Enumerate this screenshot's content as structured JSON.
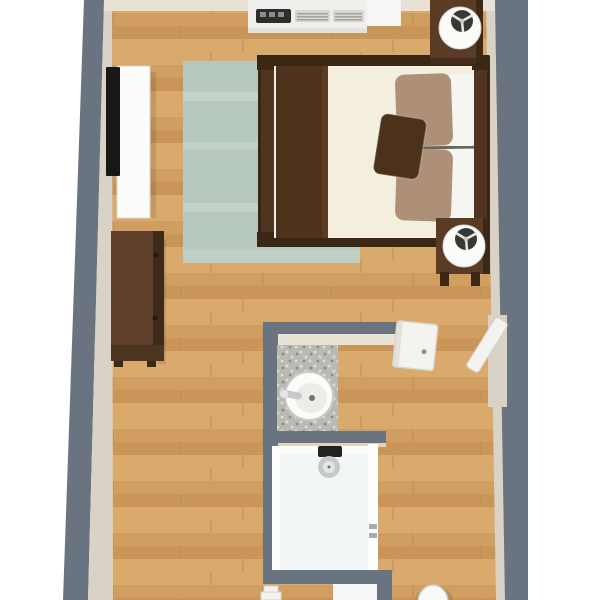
{
  "scene": {
    "objects": [
      "bedroom-floorplan",
      "wood-floor",
      "area-rug",
      "double-bed",
      "brown-blanket",
      "bed-pillows",
      "accent-pillow",
      "headboard",
      "footboard",
      "nightstand-top",
      "nightstand-bottom",
      "table-lamp-top",
      "table-lamp-bottom",
      "wall-tv",
      "tv-console",
      "dresser",
      "ptac-air-conditioner",
      "bathroom",
      "granite-vanity",
      "vessel-sink",
      "faucet",
      "walk-in-shower",
      "shower-head",
      "glass-panel",
      "bathroom-door",
      "entry-door",
      "toilet",
      "gray-walls"
    ]
  },
  "colors": {
    "bg": "#ffffff",
    "wall": "#6a7480",
    "wall_face": "#d9d3c7",
    "wall_face_light": "#e8e2d5",
    "floor_base": "#d6a265",
    "plank_a": "#deb074",
    "plank_b": "#cd9a5d",
    "plank_c": "#c08a50",
    "plank_seam": "#a97b45",
    "rug": "#b7c9bd",
    "rug_streak": "#cedbd0",
    "bed_frame": "#4f351f",
    "bed_frame_dark": "#3a2715",
    "mattress": "#f3eedd",
    "blanket": "#4e321b",
    "blanket_fold": "#5f3e23",
    "pillow_tan": "#ae8f77",
    "pillow_white": "#f5f5f2",
    "pillow_brown": "#4c311b",
    "pillow_highlight": "rgba(255,255,255,0.25)",
    "crease": "#4a463f",
    "nightstand": "#5a3c26",
    "nightstand_dark": "#3b2817",
    "lamp_shade": "#fbfbfa",
    "lamp_inner": "#3a3834",
    "lamp_glint": "#e8e8e6",
    "tv": "#181817",
    "console": "#fcfcfb",
    "console_shadow": "#d9d8d3",
    "ac_body": "#f0efed",
    "ac_cap": "#f7f6f4",
    "ac_panel": "#2e2d2c",
    "ac_button": "#8d8c8a",
    "ac_grille": "#d7d6d3",
    "ac_slat": "#a3a29f",
    "dresser_top": "#5e3f2a",
    "dresser_side": "#3f2a1a",
    "dresser_front": "#4d3421",
    "handle": "#241911",
    "granite_base": "#b9bab3",
    "granite_dark": "#898b84",
    "granite_light": "#dcddd8",
    "sink": "#fbfbfa",
    "sink_inner": "#ebede9",
    "sink_shadow": "#c9cbc6",
    "drain": "#70736e",
    "chrome": "#c6c9ca",
    "chrome_dark": "#222220",
    "chrome_light": "#e4e6e6",
    "shower_floor": "#f3f6f7",
    "glass": "#fdfefe",
    "hinge": "#a7adb2",
    "door": "#f4f3f0",
    "door_edge": "#d8d6d0",
    "door_handle": "#8e9296",
    "toilet": "#f9f9f7",
    "opening_white": "#f4f6f7",
    "shadow": "rgba(0,0,0,0.10)"
  }
}
